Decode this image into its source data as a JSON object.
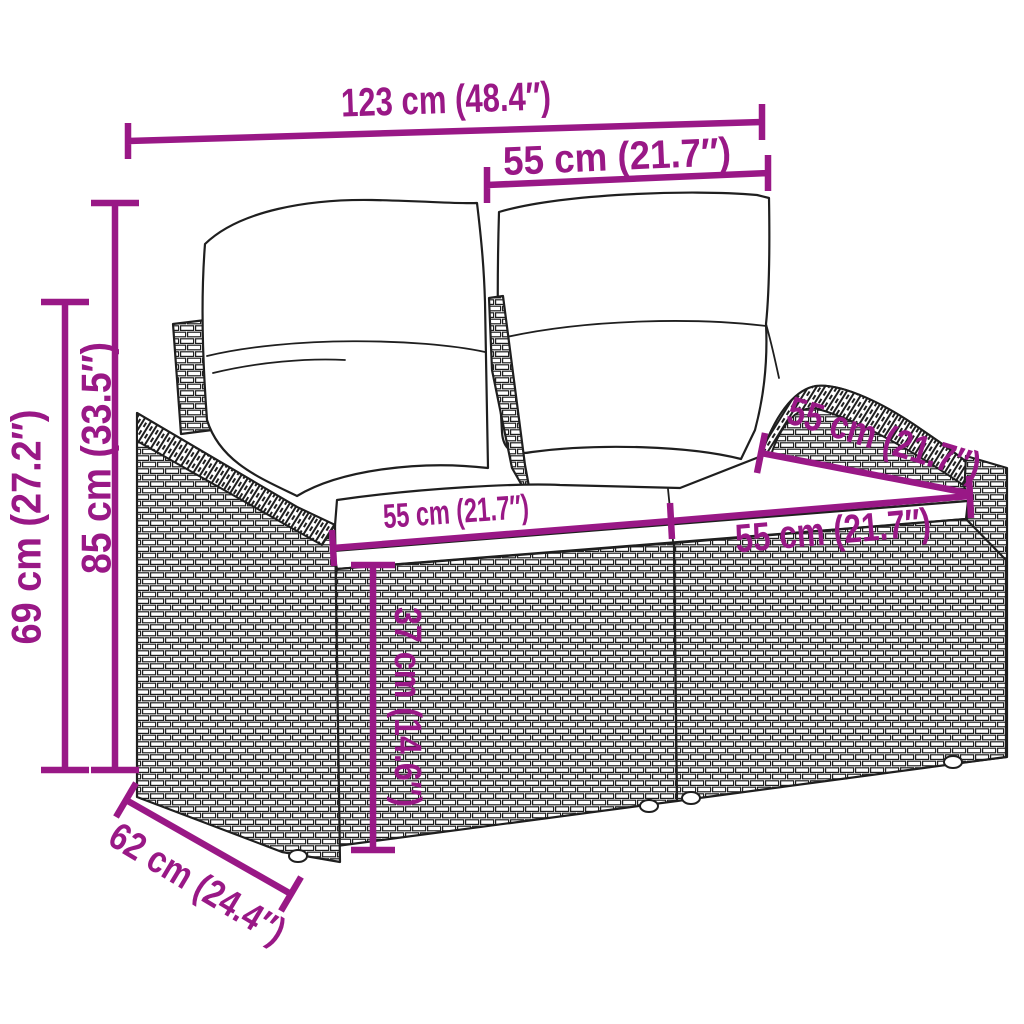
{
  "subject": "Line-art dimension diagram of a two-seater poly rattan garden sofa with back and seat cushions",
  "colors": {
    "accent": "#991886",
    "ink": "#1f1f1f",
    "background": "#ffffff"
  },
  "labels": {
    "overall_width": "123 cm (48.4″)",
    "backrest_width": "55 cm (21.7″)",
    "overall_height": "85 cm (33.5″)",
    "armrest_height": "69 cm (27.2″)",
    "seat_width_left": "55 cm (21.7″)",
    "seat_width_right": "55 cm (21.7″)",
    "seat_depth": "55 cm (21.7″)",
    "seat_height": "37 cm (14.6″)",
    "overall_depth": "62 cm (24.4″)"
  }
}
